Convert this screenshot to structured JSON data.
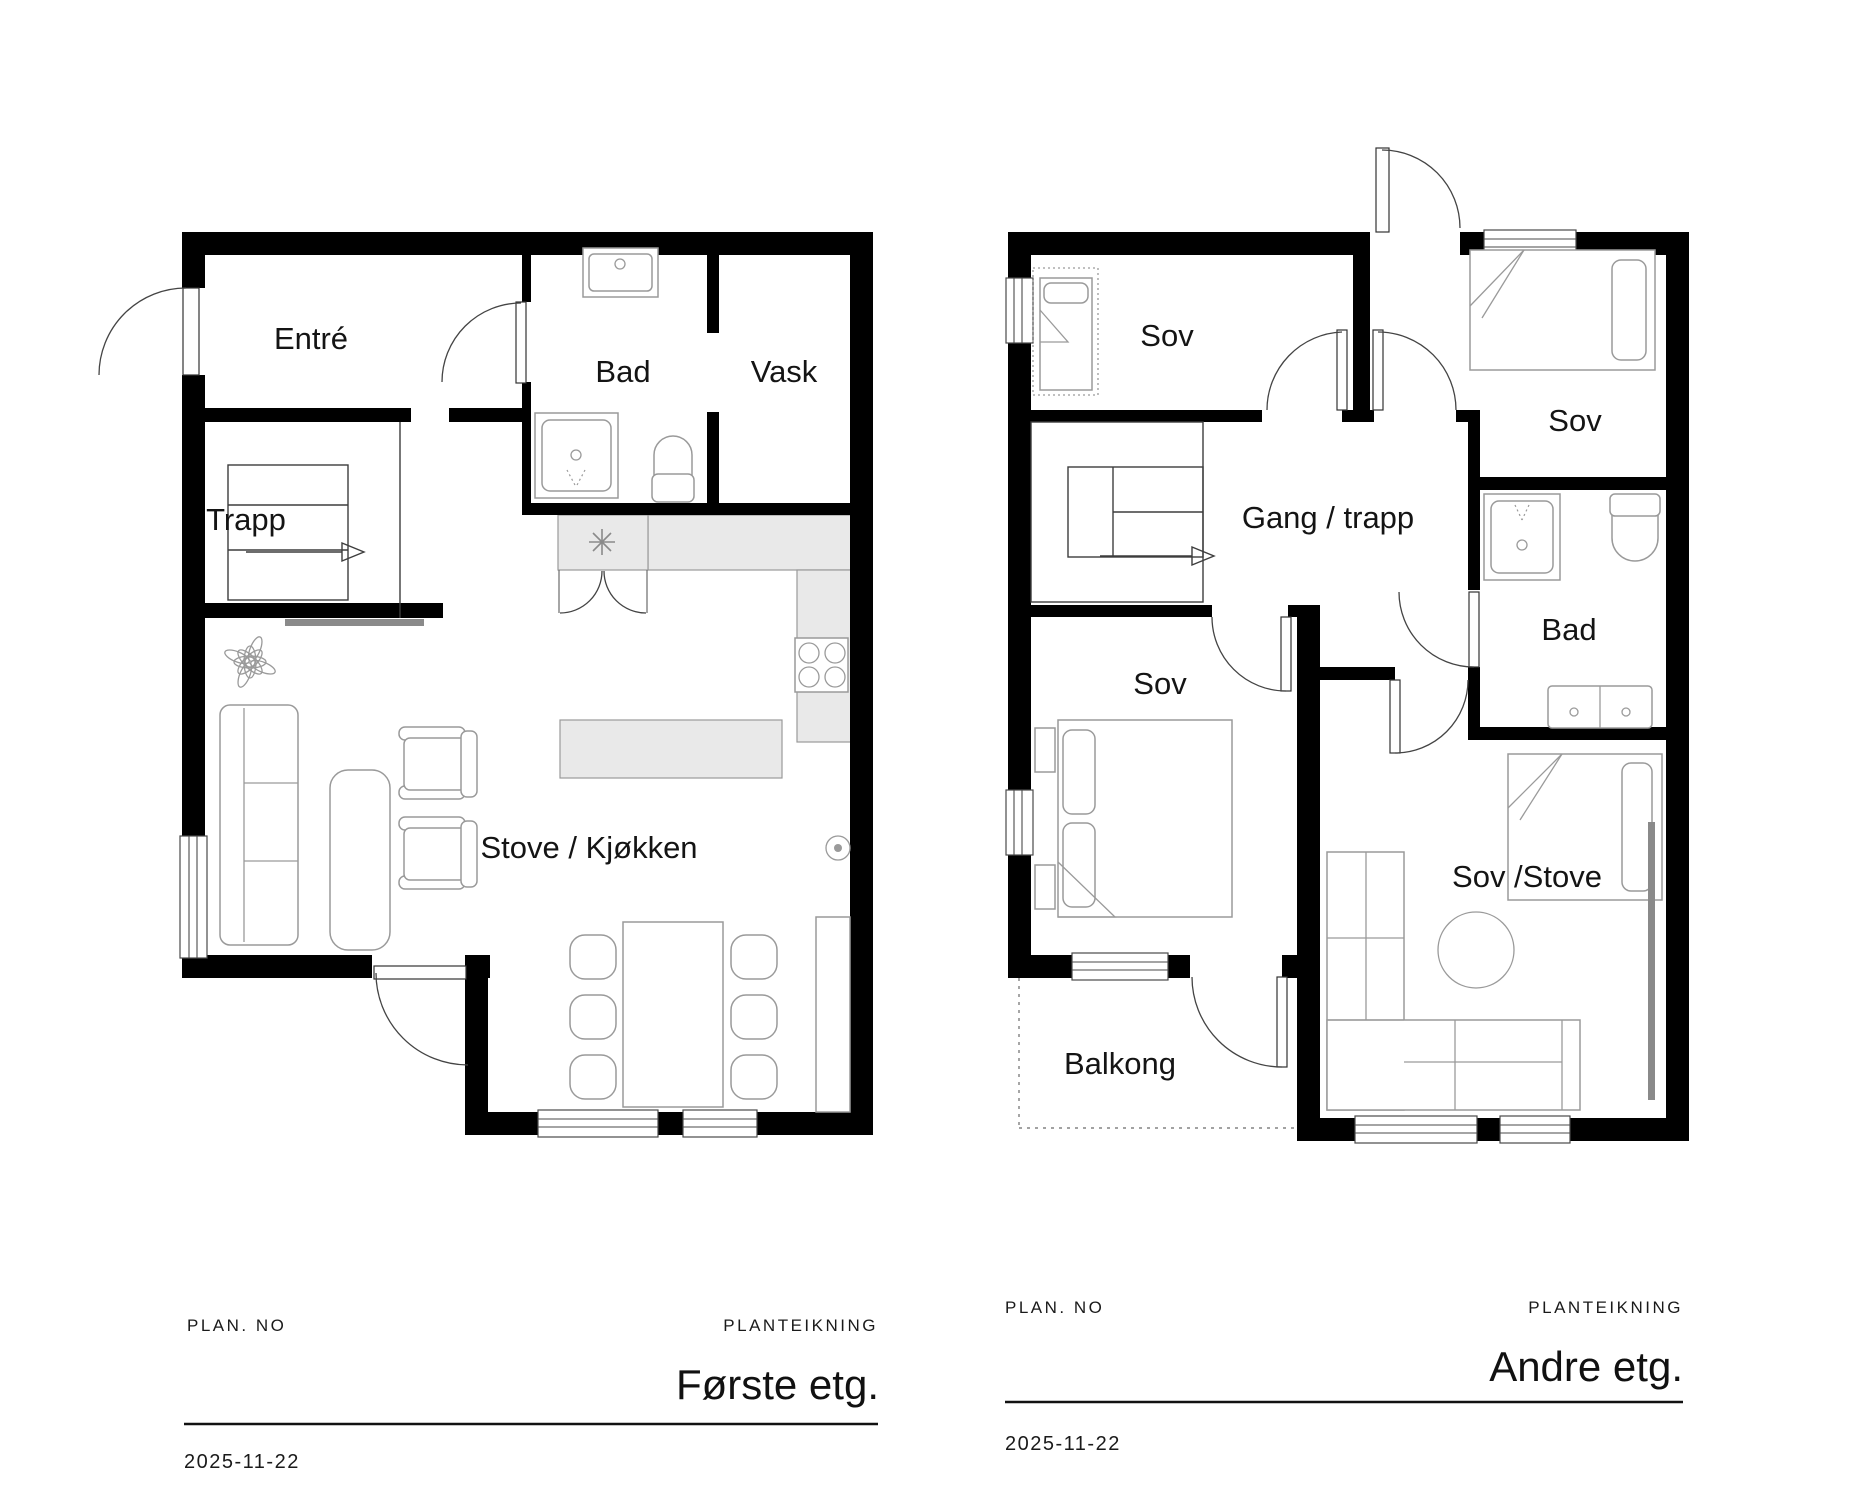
{
  "document": {
    "type": "floor-plan-drawing",
    "date": "2025-11-22"
  },
  "colors": {
    "wall": "#000000",
    "counter_fill": "#e9e9e9",
    "furniture_stroke": "#9a9a9a",
    "accent_gray": "#8a8a8a",
    "ink": "#141414"
  },
  "floor_plans": [
    {
      "name": "first-floor",
      "rooms": [
        "Entré",
        "Trapp",
        "Bad",
        "Vask",
        "Stove / Kjøkken"
      ],
      "title_block": {
        "plan_no": "PLAN. NO",
        "drawing_type": "PLANTEIKNING",
        "floor": "Første etg.",
        "date": "2025-11-22"
      }
    },
    {
      "name": "second-floor",
      "rooms": [
        "Sov",
        "Sov",
        "Gang / trapp",
        "Bad",
        "Sov",
        "Sov /Stove",
        "Balkong"
      ],
      "title_block": {
        "plan_no": "PLAN. NO",
        "drawing_type": "PLANTEIKNING",
        "floor": "Andre etg.",
        "date": "2025-11-22"
      }
    }
  ]
}
